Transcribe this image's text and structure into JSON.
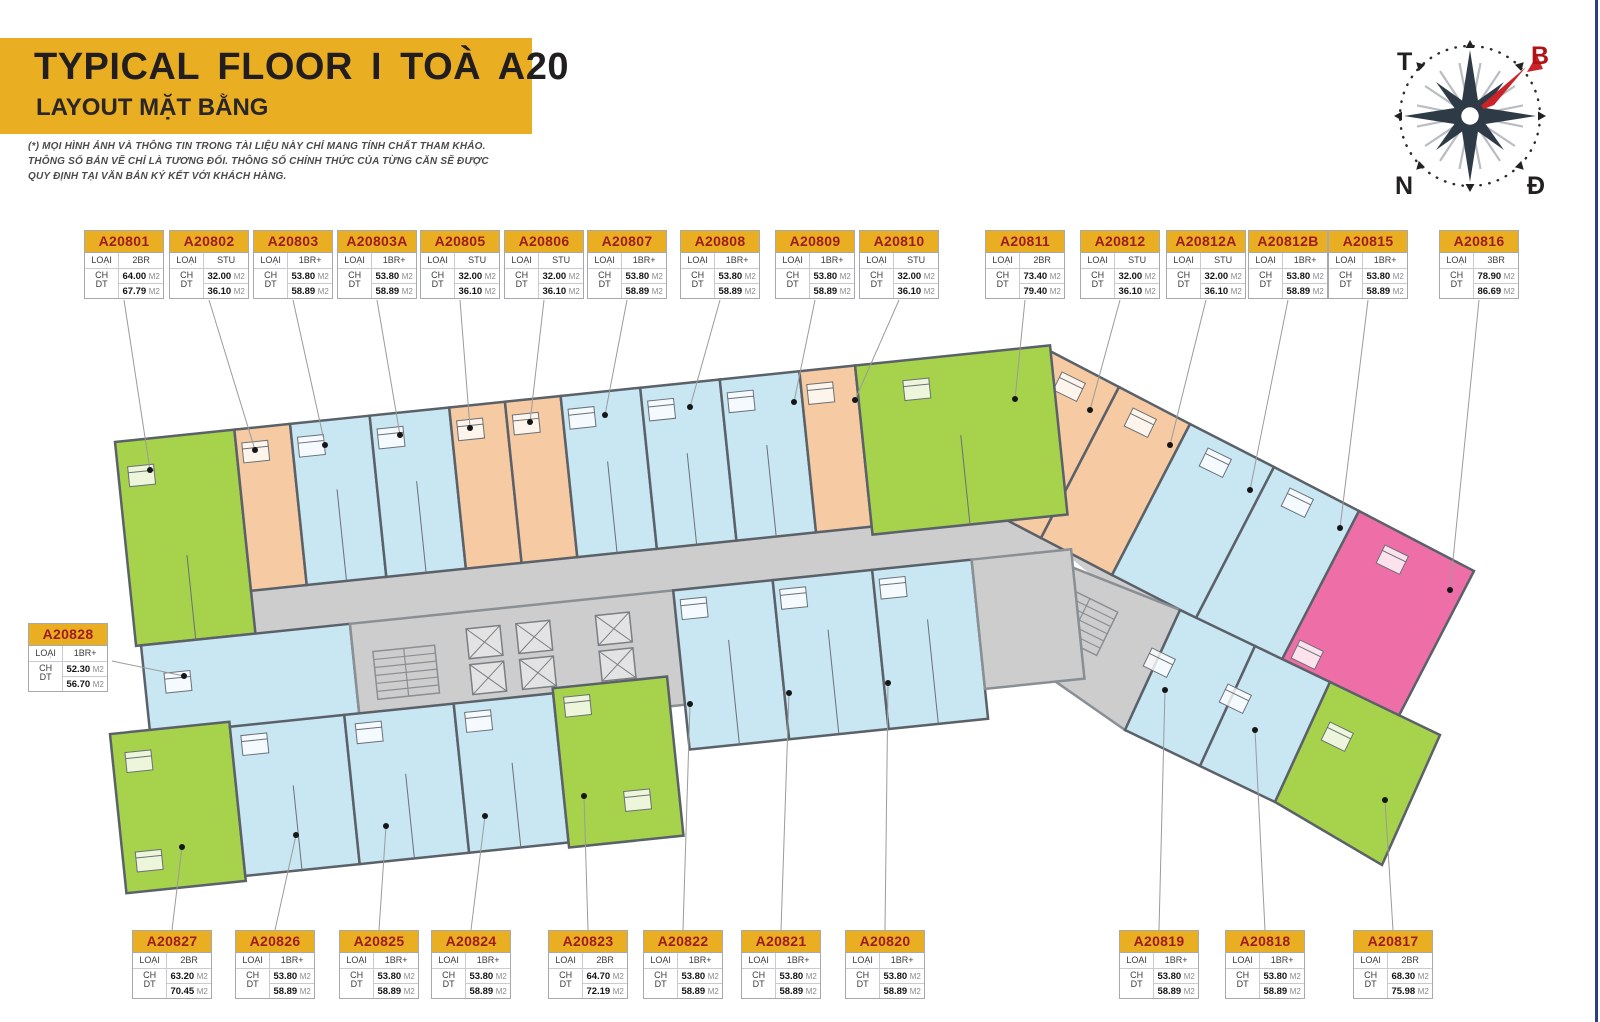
{
  "header": {
    "title": "TYPICAL FLOOR I TOÀ A20",
    "subtitle": "LAYOUT MẶT BẰNG"
  },
  "disclaimer": {
    "line1": "(*) MỌI HÌNH ẢNH VÀ THÔNG TIN TRONG TÀI LIỆU NÀY CHỈ MANG TÍNH CHẤT THAM KHẢO.",
    "line2": "THÔNG SỐ BẢN VẼ CHỈ LÀ TƯƠNG ĐỐI. THÔNG SỐ CHÍNH THỨC CỦA TỪNG CĂN SẼ ĐƯỢC",
    "line3": "QUY ĐỊNH TẠI VĂN BẢN KÝ KẾT VỚI KHÁCH HÀNG."
  },
  "compass": {
    "top_left": "T",
    "top_right": "B",
    "bottom_left": "N",
    "bottom_right": "Đ"
  },
  "labels": {
    "type_key": "LOẠI CH",
    "area_key": "DT",
    "area_unit": "M2"
  },
  "type_colors": {
    "2BR": "#a7d24c",
    "STU": "#f6caa2",
    "1BR+": "#c9e6f3",
    "3BR": "#ee6fa7",
    "corridor": "#cdcdcd",
    "accent_yellow": "#e9ae22",
    "code_red": "#9e1b1e",
    "border_navy": "#2c3f83"
  },
  "units_top": [
    {
      "code": "A20801",
      "type": "2BR",
      "area1": "64.00",
      "area2": "67.79"
    },
    {
      "code": "A20802",
      "type": "STU",
      "area1": "32.00",
      "area2": "36.10"
    },
    {
      "code": "A20803",
      "type": "1BR+",
      "area1": "53.80",
      "area2": "58.89"
    },
    {
      "code": "A20803A",
      "type": "1BR+",
      "area1": "53.80",
      "area2": "58.89"
    },
    {
      "code": "A20805",
      "type": "STU",
      "area1": "32.00",
      "area2": "36.10"
    },
    {
      "code": "A20806",
      "type": "STU",
      "area1": "32.00",
      "area2": "36.10"
    },
    {
      "code": "A20807",
      "type": "1BR+",
      "area1": "53.80",
      "area2": "58.89"
    },
    {
      "code": "A20808",
      "type": "1BR+",
      "area1": "53.80",
      "area2": "58.89"
    },
    {
      "code": "A20809",
      "type": "1BR+",
      "area1": "53.80",
      "area2": "58.89"
    },
    {
      "code": "A20810",
      "type": "STU",
      "area1": "32.00",
      "area2": "36.10"
    },
    {
      "code": "A20811",
      "type": "2BR",
      "area1": "73.40",
      "area2": "79.40"
    },
    {
      "code": "A20812",
      "type": "STU",
      "area1": "32.00",
      "area2": "36.10"
    },
    {
      "code": "A20812A",
      "type": "STU",
      "area1": "32.00",
      "area2": "36.10"
    },
    {
      "code": "A20812B",
      "type": "1BR+",
      "area1": "53.80",
      "area2": "58.89"
    },
    {
      "code": "A20815",
      "type": "1BR+",
      "area1": "53.80",
      "area2": "58.89"
    },
    {
      "code": "A20816",
      "type": "3BR",
      "area1": "78.90",
      "area2": "86.69"
    }
  ],
  "unit_left": {
    "code": "A20828",
    "type": "1BR+",
    "area1": "52.30",
    "area2": "56.70"
  },
  "units_bottom": [
    {
      "code": "A20827",
      "type": "2BR",
      "area1": "63.20",
      "area2": "70.45"
    },
    {
      "code": "A20826",
      "type": "1BR+",
      "area1": "53.80",
      "area2": "58.89"
    },
    {
      "code": "A20825",
      "type": "1BR+",
      "area1": "53.80",
      "area2": "58.89"
    },
    {
      "code": "A20824",
      "type": "1BR+",
      "area1": "53.80",
      "area2": "58.89"
    },
    {
      "code": "A20823",
      "type": "2BR",
      "area1": "64.70",
      "area2": "72.19"
    },
    {
      "code": "A20822",
      "type": "1BR+",
      "area1": "53.80",
      "area2": "58.89"
    },
    {
      "code": "A20821",
      "type": "1BR+",
      "area1": "53.80",
      "area2": "58.89"
    },
    {
      "code": "A20820",
      "type": "1BR+",
      "area1": "53.80",
      "area2": "58.89"
    },
    {
      "code": "A20819",
      "type": "1BR+",
      "area1": "53.80",
      "area2": "58.89"
    },
    {
      "code": "A20818",
      "type": "1BR+",
      "area1": "53.80",
      "area2": "58.89"
    },
    {
      "code": "A20817",
      "type": "2BR",
      "area1": "68.30",
      "area2": "75.98"
    }
  ]
}
